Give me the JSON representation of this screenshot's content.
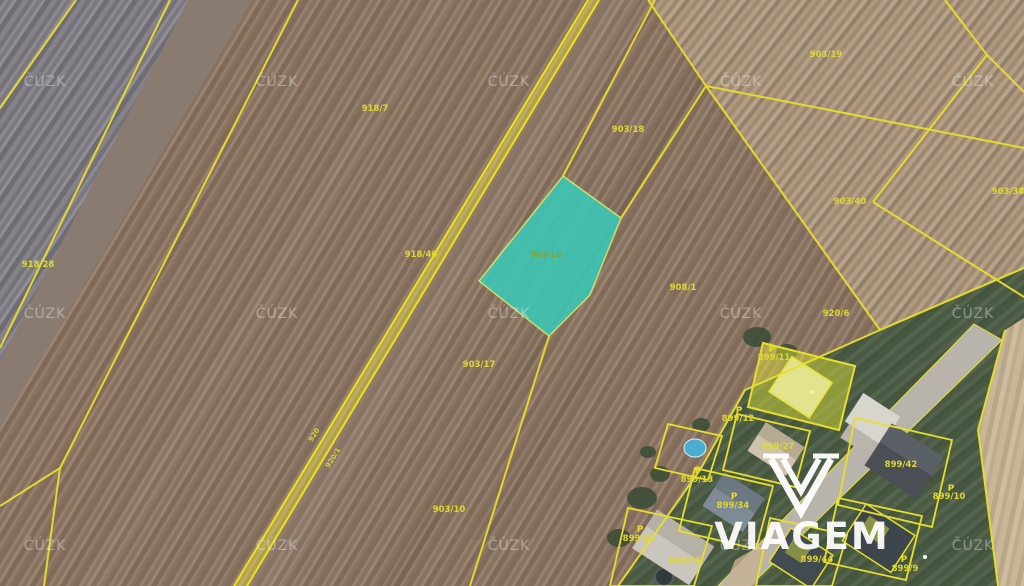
{
  "watermark_text": "ČÚZK",
  "brand_text": "VIAGEM",
  "highlight_label": "903/16",
  "symbol_p": "P",
  "labels": [
    "918/7",
    "903/18",
    "903/19",
    "903/38",
    "903/40",
    "918/28",
    "918/40",
    "908/1",
    "920/6",
    "903/17",
    "903/10",
    "899/11",
    "899/12",
    "899/27",
    "899/42",
    "899/10",
    "899/13",
    "899/34",
    "899/14",
    "899/15",
    "899/44",
    "899/9"
  ],
  "road_labels": [
    "920",
    "920/1"
  ],
  "colors": {
    "parcel_line": "#e8df2a",
    "highlight_fill": "#3cc8b8",
    "highlight_stroke": "#d6ee66",
    "selected_parcel_fill": "rgba(228,230,55,0.45)",
    "road_fill": "rgba(235,225,70,0.45)"
  }
}
